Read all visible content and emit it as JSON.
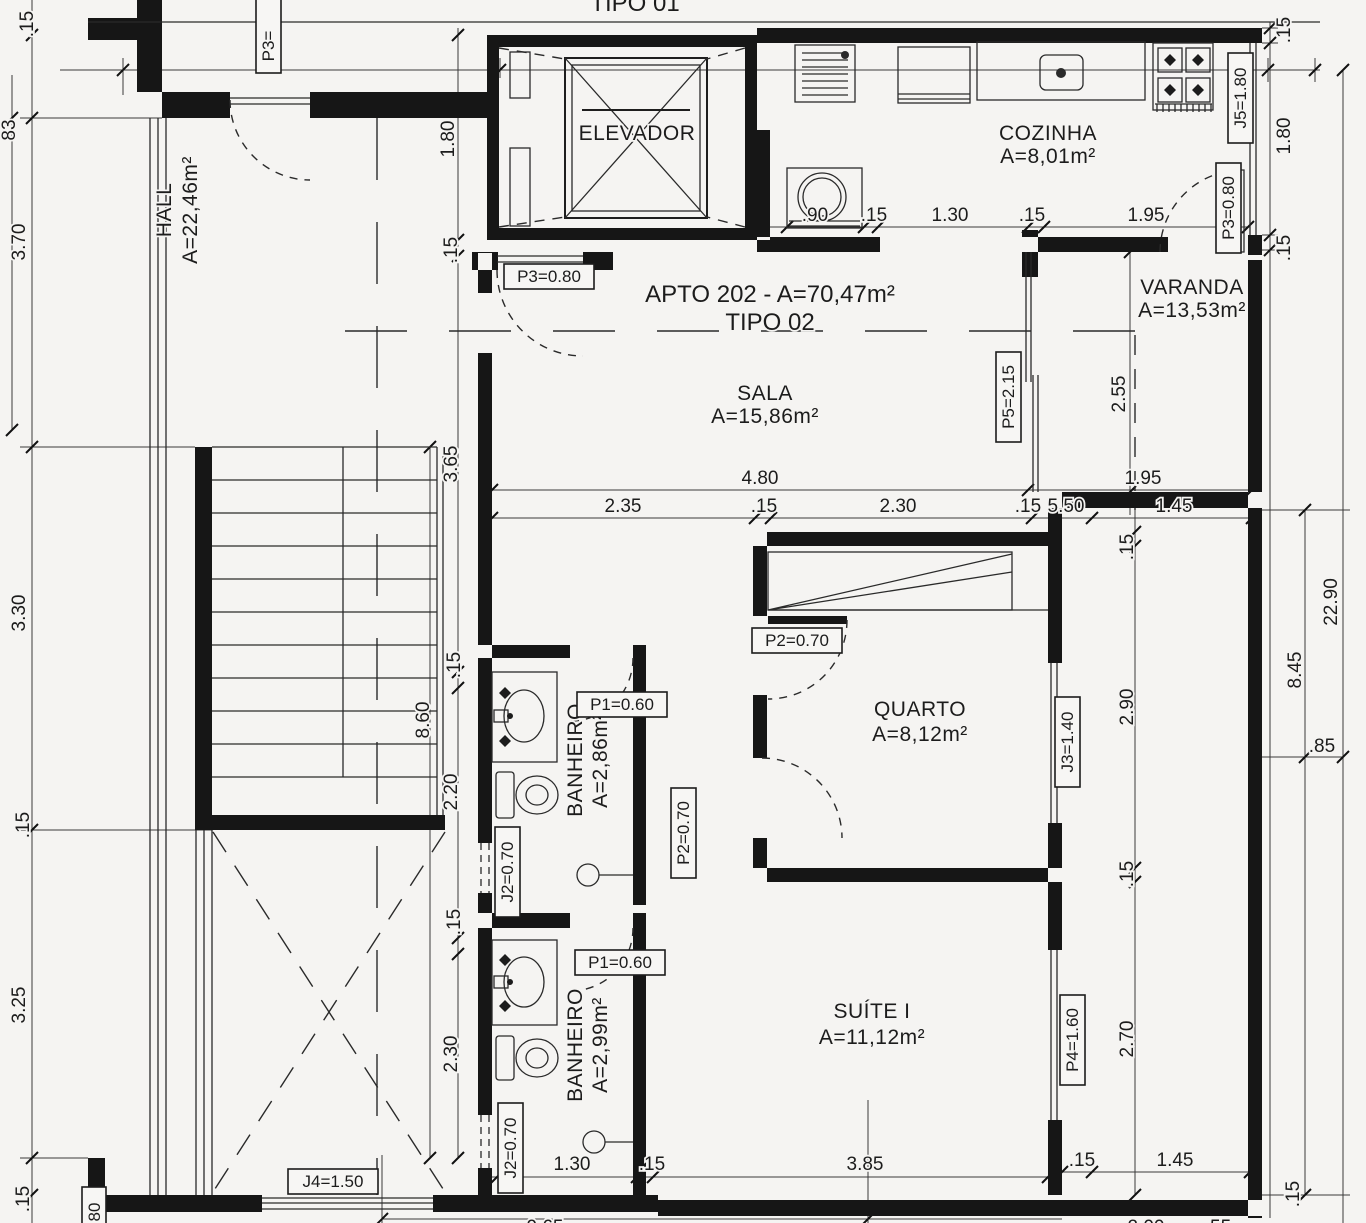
{
  "colors": {
    "background": "#f5f4f2",
    "line": "#1e1e1e",
    "wall": "#161616"
  },
  "title": {
    "apto": "APTO 202 - A=70,47m²",
    "tipo": "TIPO 02"
  },
  "partials": {
    "top_cut": "TIPO 01",
    "bottom_965": "9.65",
    "bottom_200": "2.00",
    "bottom_55": ".55",
    "left_83": "83",
    "tag_p3_cut": "P3=",
    "tag_bl_cut": "80"
  },
  "rooms": {
    "elevador": {
      "name": "ELEVADOR"
    },
    "cozinha": {
      "name": "COZINHA",
      "area": "A=8,01m²"
    },
    "hall": {
      "name": "HALL",
      "area": "A=22,46m²"
    },
    "sala": {
      "name": "SALA",
      "area": "A=15,86m²"
    },
    "varanda": {
      "name": "VARANDA",
      "area": "A=13,53m²"
    },
    "quarto": {
      "name": "QUARTO",
      "area": "A=8,12m²"
    },
    "banheiro_sala": {
      "name": "BANHEIRO",
      "area": "A=2,86m²"
    },
    "banheiro_suite": {
      "name": "BANHEIRO",
      "area": "A=2,99m²"
    },
    "suite": {
      "name": "SUÍTE I",
      "area": "A=11,12m²"
    }
  },
  "openings": {
    "p3_hall": "P3=0.80",
    "p3_varanda": "P3=0.80",
    "p5_varanda": "P5=2.15",
    "p2_quarto": "P2=0.70",
    "p2_corridor": "P2=0.70",
    "p1_banheiro1": "P1=0.60",
    "p1_banheiro2": "P1=0.60",
    "j2_banheiro1": "J2=0.70",
    "j2_banheiro2": "J2=0.70",
    "j3_quarto": "J3=1.40",
    "j4_bottom": "J4=1.50",
    "j5_cozinha": "J5=1.80",
    "p4_suite": "P4=1.60"
  },
  "dims": {
    "left_15_top": ".15",
    "left_370": "3.70",
    "left_330": "3.30",
    "left_15_mid": ".15",
    "left_325": "3.25",
    "left_15_bot": ".15",
    "elev_180": "1.80",
    "elev_15": ".15",
    "mid_365": "3.65",
    "mid_15a": ".15",
    "mid_860": "8.60",
    "mid_220": "2.20",
    "mid_15b": ".15",
    "mid_230": "2.30",
    "kit_90": ".90",
    "kit_15a": ".15",
    "kit_130": "1.30",
    "kit_15b": ".15",
    "kit_195": "1.95",
    "sala_480": "4.80",
    "sala_195": "1.95",
    "sala_235": "2.35",
    "sala_15a": ".15",
    "sala_230": "2.30",
    "sala_15b": ".15",
    "sala_550": "5.50",
    "sala_145": "1.45",
    "var_255": "2.55",
    "q_15a": ".15",
    "q_290": "2.90",
    "q_15b": ".15",
    "q_270": "2.70",
    "r_15a": ".15",
    "r_180": "1.80",
    "r_15b": ".15",
    "r_845": "8.45",
    "r_2290": "22.90",
    "r_85": ".85",
    "r_15c": ".15",
    "bot_130": "1.30",
    "bot_15a": ".15",
    "bot_385": "3.85",
    "bot_15b": ".15",
    "bot_145": "1.45"
  }
}
